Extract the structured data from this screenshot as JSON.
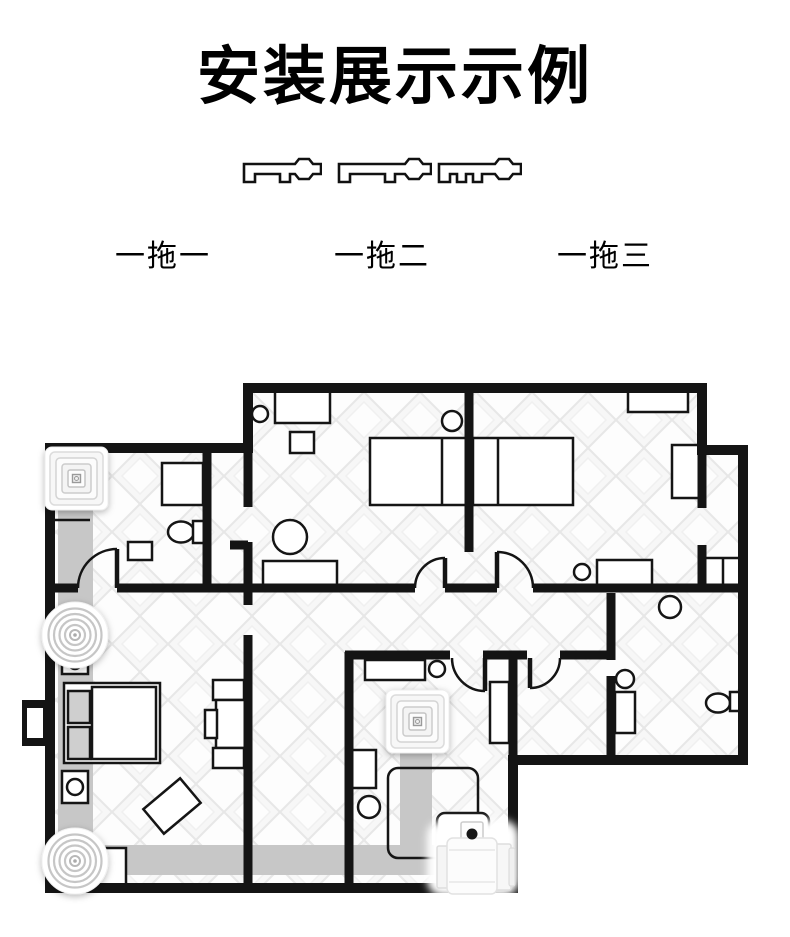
{
  "page": {
    "background": "#ffffff"
  },
  "header": {
    "title": "安装展示示例"
  },
  "modes": [
    {
      "label": "一拖一",
      "icon": "duct-manifold-1-outlet-icon"
    },
    {
      "label": "一拖二",
      "icon": "duct-manifold-2-outlet-icon"
    },
    {
      "label": "一拖三",
      "icon": "duct-manifold-3-outlet-icon"
    }
  ],
  "floorplan": {
    "wall_color": "#141414",
    "duct_color": "#c7c7c7",
    "floor_tile_color": "#e9e9e9",
    "fixtures": [
      "ceiling-cassette-fan-bathroom",
      "round-diffuser-upper",
      "round-diffuser-lower",
      "ceiling-cassette-fan-center",
      "inline-duct-fan-unit"
    ]
  }
}
